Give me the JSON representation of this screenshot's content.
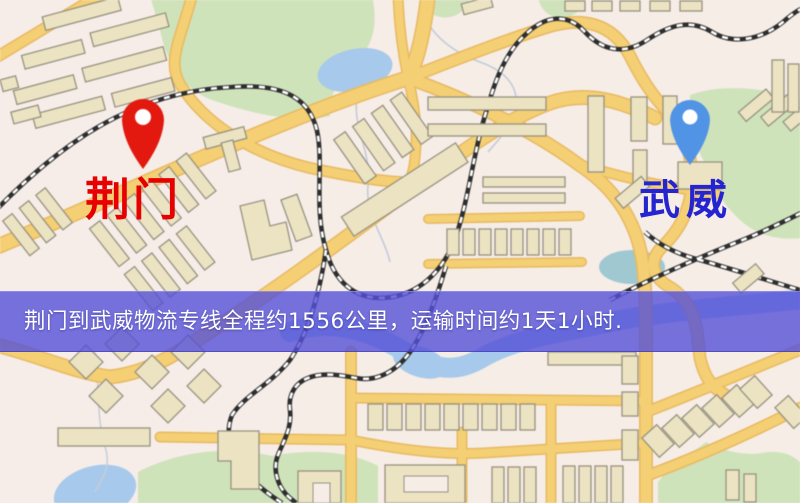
{
  "banner": {
    "text": "荆门到武威物流专线全程约1556公里，运输时间约1天1小时.",
    "origin": "荆门",
    "destination": "武威",
    "distance": "1556公里",
    "duration": "1天1小时",
    "background_color": "#5550d7",
    "text_color": "#ffffff"
  },
  "markers": {
    "origin": {
      "label": "荆门",
      "label_color": "#e60000",
      "pin_color": "#e8170c",
      "pin_icon": "red-map-pin"
    },
    "destination": {
      "label": "武威",
      "label_color": "#2424d0",
      "pin_color": "#4f93e8",
      "pin_icon": "blue-map-pin"
    }
  },
  "map_palette": {
    "background": "#f6ede7",
    "road": "#f5cf70",
    "road_border": "#e9b95f",
    "building": "#ece3c2",
    "building_outline": "#97927f",
    "park": "#cfe3ba",
    "water": "#a6c9ec",
    "railway": "#2e2e2e"
  }
}
